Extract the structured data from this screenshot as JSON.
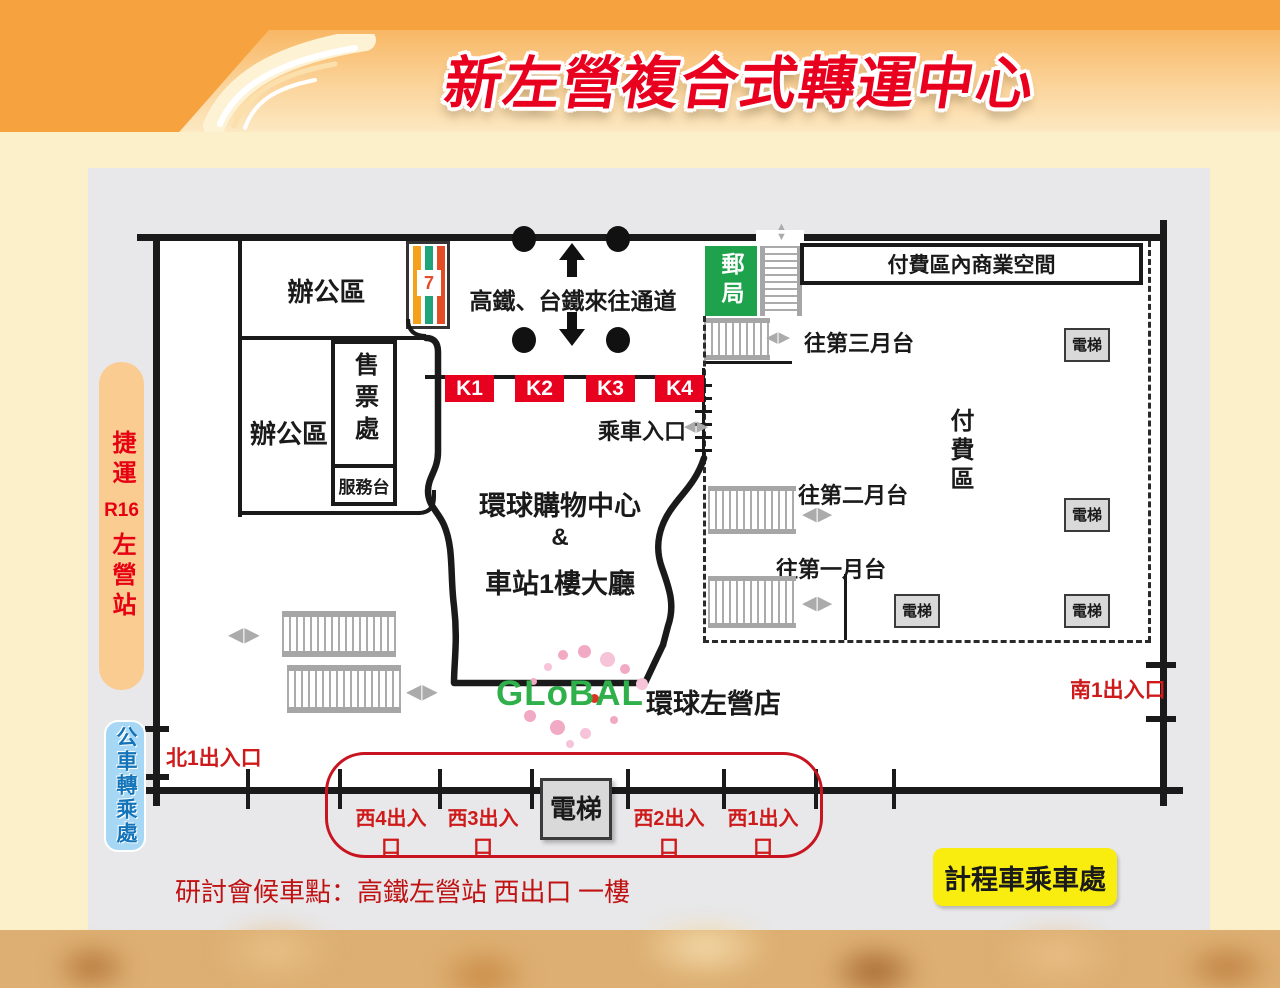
{
  "title": "新左營複合式轉運中心",
  "note": "研討會候車點：高鐵左營站 西出口 一樓",
  "building": {
    "office_upper": "辦公區",
    "office_lower": "辦公區",
    "ticket_office": "售票處",
    "service_desk": "服務台",
    "seven_label": "7",
    "passage": "高鐵、台鐵來往通道",
    "post_office": "郵局",
    "commercial": "付費區內商業空間",
    "paid_area": "付費區",
    "kiosks": [
      "K1",
      "K2",
      "K3",
      "K4"
    ],
    "boarding": "乘車入口",
    "mall_name": "環球購物中心",
    "mall_amp": "&",
    "mall_lobby": "車站1樓大廳",
    "platform3": "往第三月台",
    "platform2": "往第二月台",
    "platform1": "往第一月台",
    "elevator": "電梯",
    "global_logo": "GLoBAL",
    "global_store": "環球左營店",
    "arrow_lr": "◀▶",
    "arrow_up": "▲",
    "arrow_down": "▼"
  },
  "exits": {
    "north": "北1出入口",
    "south": "南1出入口",
    "west4": "西4出入口",
    "west3": "西3出入口",
    "west2": "西2出入口",
    "west1": "西1出入口"
  },
  "transit": {
    "mrt_line1": "捷運",
    "mrt_code": "R16",
    "mrt_line2": "左營站",
    "bus": "公車轉乘處",
    "taxi": "計程車乘車處"
  },
  "colors": {
    "accent_red": "#E8001E",
    "exit_red": "#CE1A1A",
    "post_green": "#1EA24B",
    "taxi_yellow": "#F8ED0E",
    "mrt_bar": "#FACC92",
    "bus_bar": "#A6D7F4",
    "bus_text": "#1374BA",
    "global_green": "#2FB04A",
    "flower_pink": "#F2A9C4"
  }
}
